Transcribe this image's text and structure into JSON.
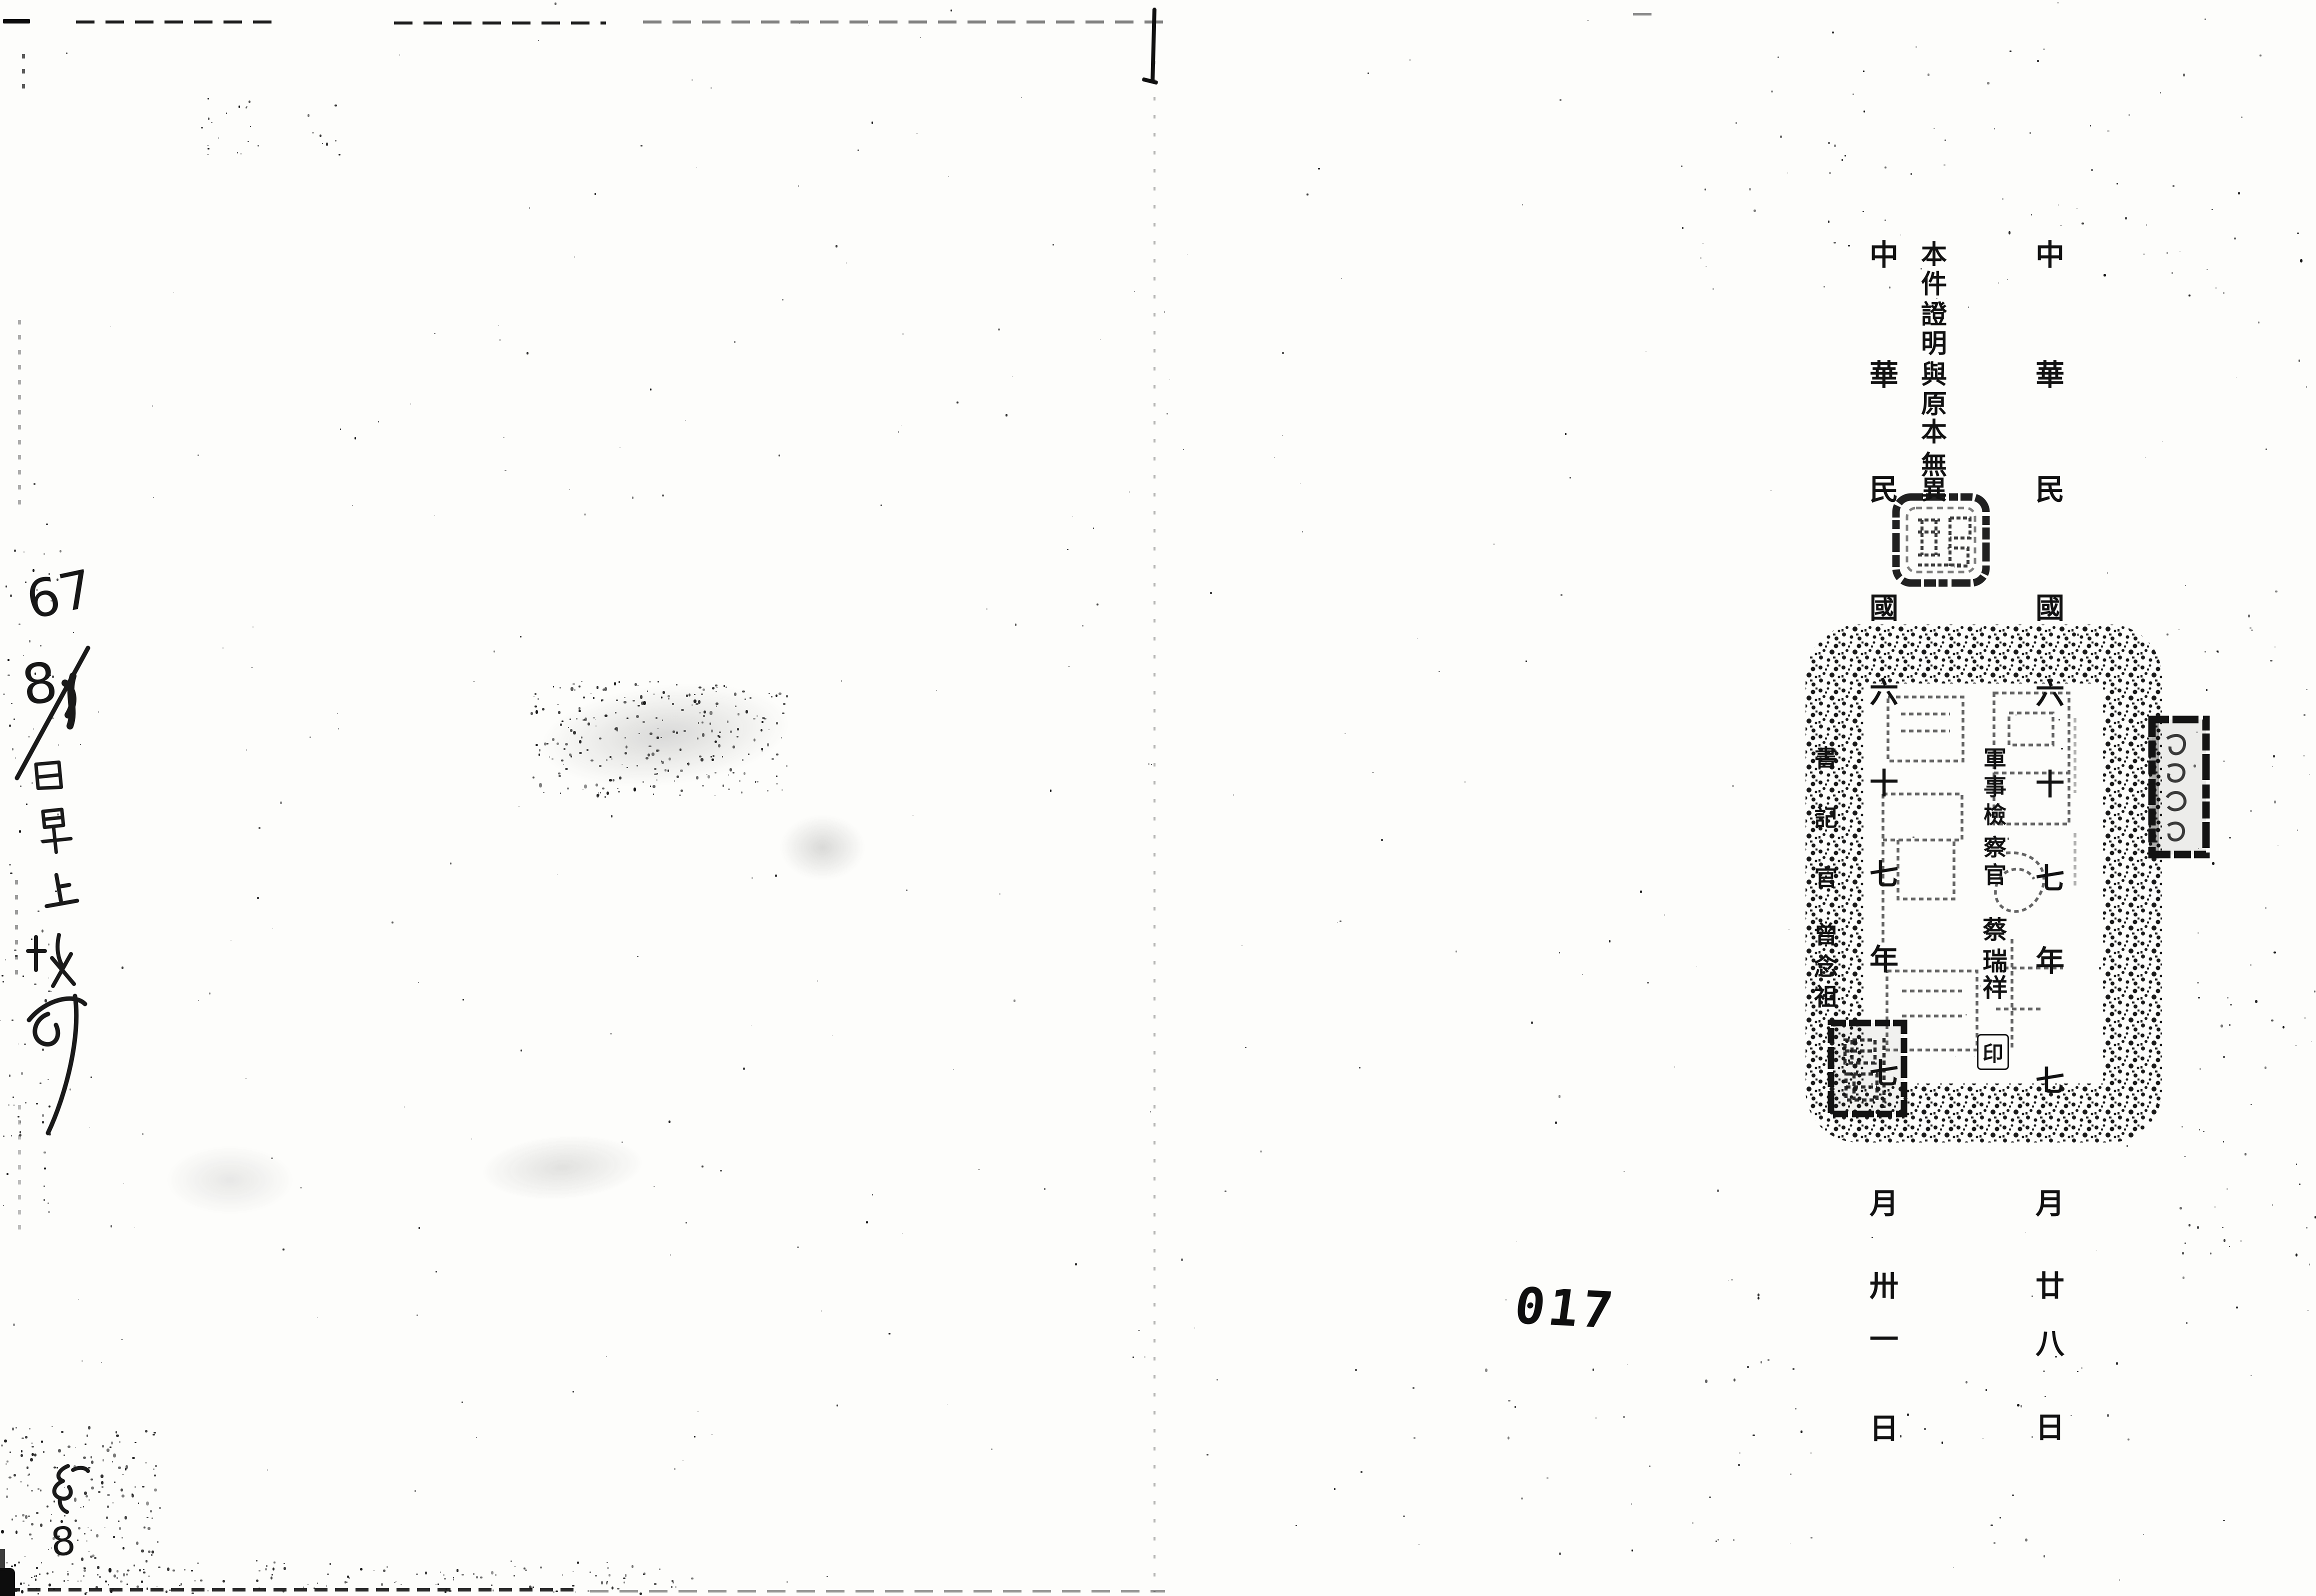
{
  "document": {
    "page_number": "017",
    "certification_text": "本件證明與原本無異",
    "prosecutor": {
      "title": "軍事檢察官",
      "name": "蔡瑞祥",
      "seal_mark": "印",
      "date": "中華民國六十七年七月廿八日"
    },
    "clerk": {
      "title": "書記官",
      "name": "曾念祖",
      "date": "中華民國六十七年七月卅一日"
    },
    "handwriting": {
      "year": "67",
      "month": "8",
      "day": "1",
      "body": "日早上收卯",
      "bottom_mark": "㐧",
      "bottom_number": "8"
    }
  }
}
